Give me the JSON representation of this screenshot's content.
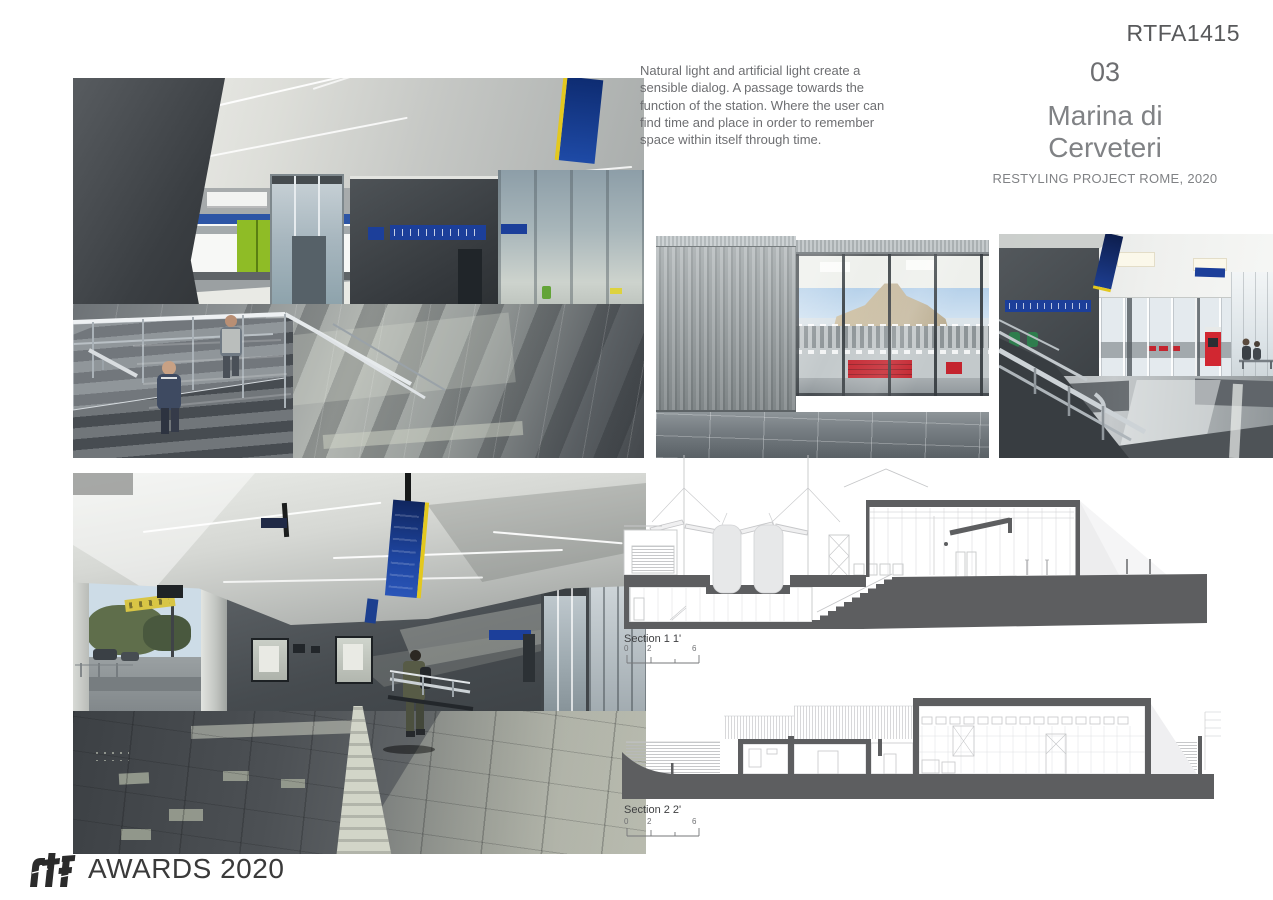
{
  "header": {
    "code": "RTFA1415"
  },
  "description": {
    "text": "Natural light and artificial light create a sensible dialog. A passage towards the function of the station. Where the user can find time and place in order to remember space within itself through time."
  },
  "project": {
    "number": "03",
    "title": "Marina di Cerveteri",
    "subtitle": "RESTYLING PROJECT ROME, 2020"
  },
  "sections": [
    {
      "label": "Section 1 1'",
      "scale": {
        "start": "0",
        "mid": "2",
        "end": "6"
      }
    },
    {
      "label": "Section 2 2'",
      "scale": {
        "start": "0",
        "mid": "2",
        "end": "6"
      }
    }
  ],
  "footer": {
    "logo_text": "rtf",
    "awards": "AWARDS 2020"
  },
  "photos": [
    {
      "name": "station-interior-staircase"
    },
    {
      "name": "station-exterior-glass-facade"
    },
    {
      "name": "station-hall-interior"
    },
    {
      "name": "station-canopy-passage"
    }
  ],
  "colors": {
    "accent_blue": "#1c3f9a",
    "navy_sign": "#16307a",
    "sign_yellow": "#e3c81f",
    "bench_red": "#c4242e",
    "machine_red": "#d12731",
    "train_green": "#8fbc26",
    "defib_green": "#2e7d4d",
    "drawing_dark": "#5d5e60",
    "drawing_line": "#c6c7c9",
    "code_text": "#58595b",
    "body_text": "#6d6e71",
    "title_text": "#808285"
  }
}
